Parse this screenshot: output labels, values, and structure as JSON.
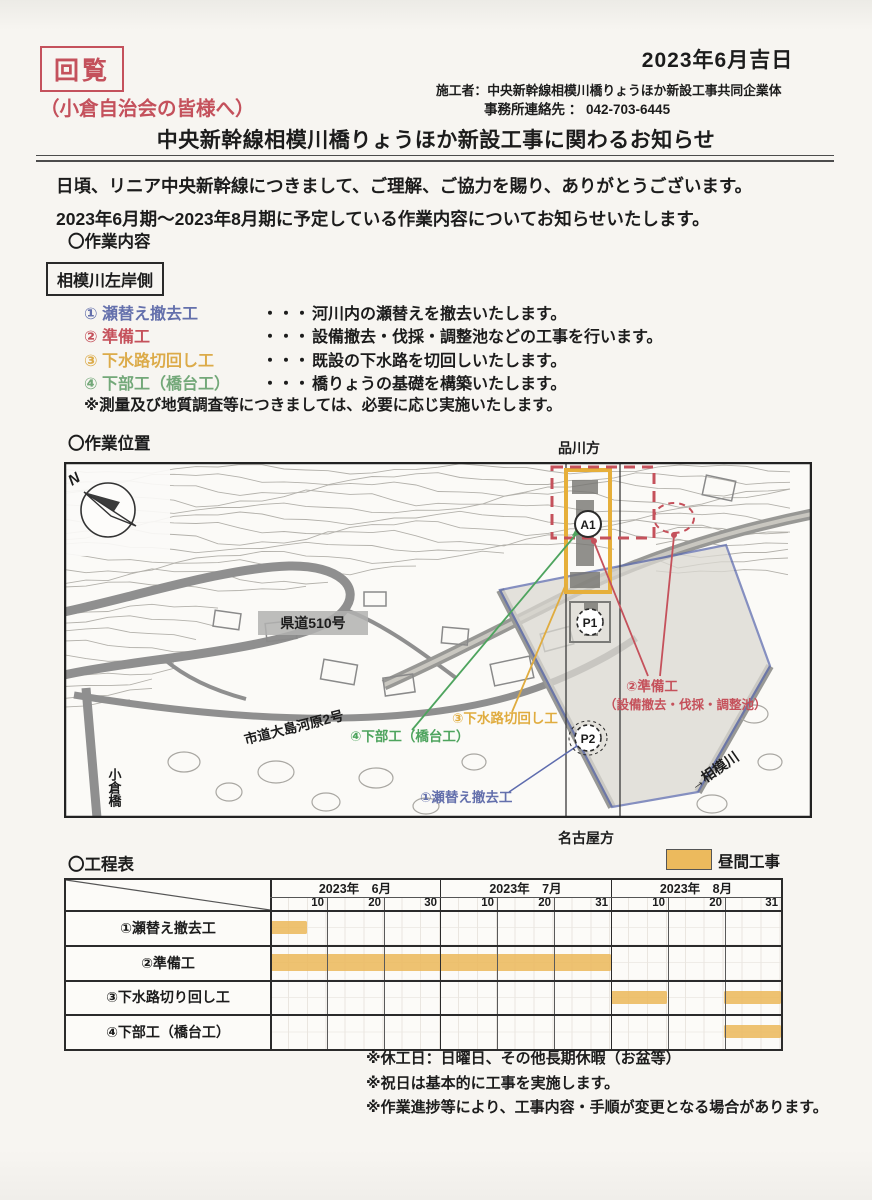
{
  "page": {
    "stamp": "回覧",
    "date": "2023年6月吉日",
    "contractor": "施工者：中央新幹線相模川橋りょうほか新設工事共同企業体",
    "office_contact": "事務所連絡先 ： 042-703-6445",
    "addressee": "（小倉自治会の皆様へ）",
    "title": "中央新幹線相模川橋りょうほか新設工事に関わるお知らせ",
    "greeting_line1": "日頃、リニア中央新幹線につきまして、ご理解、ご協力を賜り、ありがとうございます。",
    "greeting_line2": "2023年6月期～2023年8月期に予定している作業内容についてお知らせいたします。",
    "accent_red": "#c4515c"
  },
  "work_content": {
    "heading": "〇作業内容",
    "area_label": "相模川左岸側",
    "items": [
      {
        "no": "①",
        "name": "瀬替え撤去工",
        "dots": "・・・",
        "desc": "河川内の瀬替えを撤去いたします。",
        "color": "#6470ac"
      },
      {
        "no": "②",
        "name": "準備工",
        "dots": "・・・",
        "desc": "設備撤去・伐採・調整池などの工事を行います。",
        "color": "#c5515b"
      },
      {
        "no": "③",
        "name": "下水路切回し工",
        "dots": "・・・",
        "desc": "既設の下水路を切回しいたします。",
        "color": "#dcab49"
      },
      {
        "no": "④",
        "name": "下部工（橋台工）",
        "dots": "・・・",
        "desc": "橋りょうの基礎を構築いたします。",
        "color": "#73a879"
      }
    ],
    "note": "※測量及び地質調査等につきましては、必要に応じ実施いたします。"
  },
  "location": {
    "heading": "〇作業位置",
    "direction_top": "品川方",
    "direction_bottom": "名古屋方",
    "map_labels": {
      "north": "N",
      "route510": "県道510号",
      "city_road": "市道大島河原2号",
      "ogura_bridge": "小倉橋",
      "river": "→相模川",
      "marker_a1": "A1",
      "marker_p1": "P1",
      "marker_p2": "P2",
      "label1": "①瀬替え撤去工",
      "label2_line1": "②準備工",
      "label2_line2": "（設備撤去・伐採・調整池）",
      "label3": "③下水路切回し工",
      "label4": "④下部工（橋台工）"
    },
    "colors": {
      "work_area_blue": "#5e6cae",
      "zone_yellow": "#e6af3a",
      "zone_red": "#c5515b",
      "leader_green": "#4ea45e",
      "leader_yellow": "#e0ac3f",
      "label_blue": "#6470ac"
    }
  },
  "schedule": {
    "heading": "〇工程表",
    "legend_label": "昼間工事",
    "legend_color": "#ecba5d",
    "months": [
      {
        "label": "2023年　6月",
        "days": [
          "10",
          "20",
          "30"
        ]
      },
      {
        "label": "2023年　7月",
        "days": [
          "10",
          "20",
          "31"
        ]
      },
      {
        "label": "2023年　8月",
        "days": [
          "10",
          "20",
          "31"
        ]
      }
    ],
    "rows": [
      {
        "task": "①瀬替え撤去工",
        "bars": [
          {
            "start_col": 0,
            "end_col": 0.65
          }
        ]
      },
      {
        "task": "②準備工",
        "bars": [
          {
            "start_col": 0,
            "end_col": 6
          }
        ]
      },
      {
        "task": "③下水路切り回し工",
        "bars": [
          {
            "start_col": 6,
            "end_col": 7
          },
          {
            "start_col": 8,
            "end_col": 9
          }
        ]
      },
      {
        "task": "④下部工（橋台工）",
        "bars": [
          {
            "start_col": 8,
            "end_col": 9
          }
        ]
      }
    ],
    "notes": [
      "※休工日：日曜日、その他長期休暇（お盆等）",
      "※祝日は基本的に工事を実施します。",
      "※作業進捗等により、工事内容・手順が変更となる場合があります。"
    ]
  }
}
